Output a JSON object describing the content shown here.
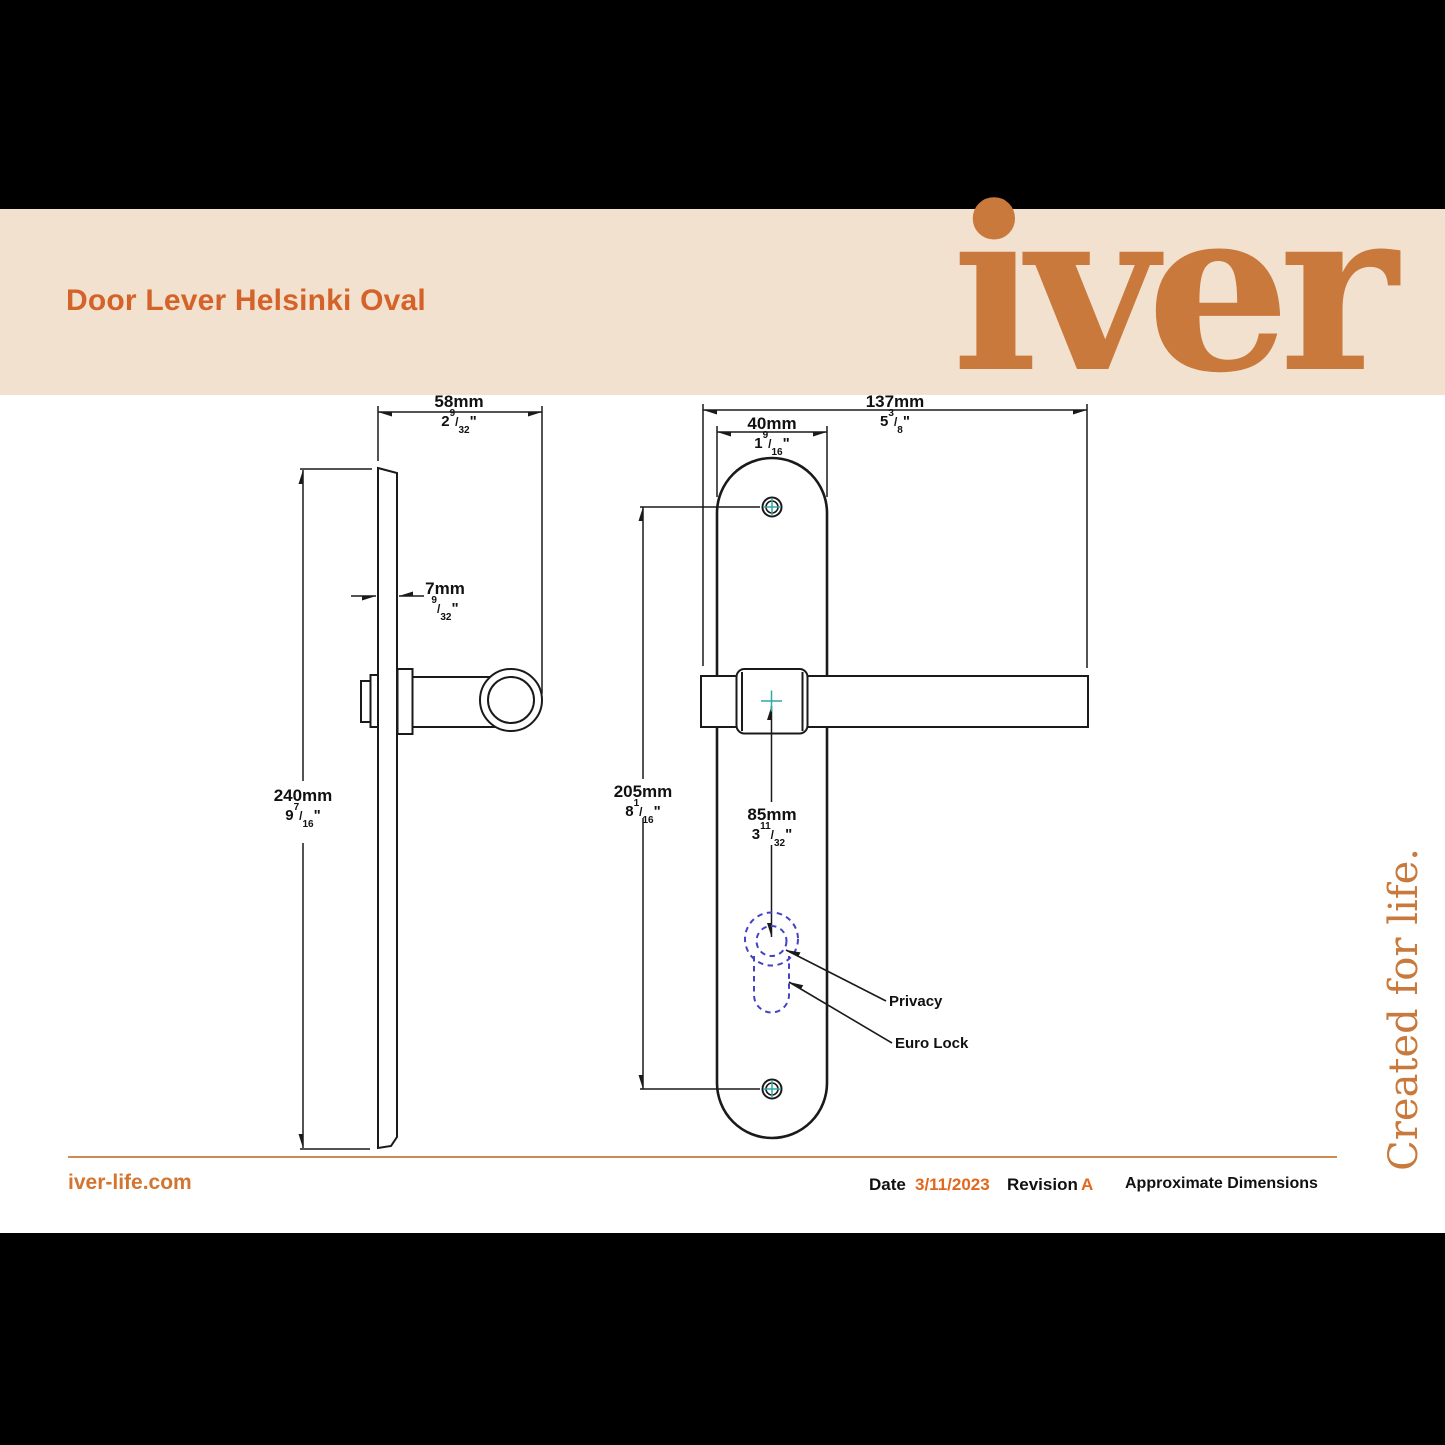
{
  "header": {
    "title": "Door Lever Helsinki Oval",
    "brand_logo": "iver"
  },
  "tagline": "Created for life.",
  "drawing": {
    "dimensions": {
      "side_width": {
        "metric": "58mm",
        "inch_whole": "2",
        "inch_num": "9",
        "inch_den": "32"
      },
      "plate_thickness": {
        "metric": "7mm",
        "inch_whole": "",
        "inch_num": "9",
        "inch_den": "32"
      },
      "plate_height": {
        "metric": "240mm",
        "inch_whole": "9",
        "inch_num": "7",
        "inch_den": "16"
      },
      "overall_width": {
        "metric": "137mm",
        "inch_whole": "5",
        "inch_num": "3",
        "inch_den": "8"
      },
      "plate_width": {
        "metric": "40mm",
        "inch_whole": "1",
        "inch_num": "9",
        "inch_den": "16"
      },
      "screw_centres": {
        "metric": "205mm",
        "inch_whole": "8",
        "inch_num": "1",
        "inch_den": "16"
      },
      "lever_to_keyhole": {
        "metric": "85mm",
        "inch_whole": "3",
        "inch_num": "11",
        "inch_den": "32"
      }
    },
    "callouts": {
      "privacy": "Privacy",
      "euro_lock": "Euro Lock"
    },
    "marks": {
      "fraction_slash": "/",
      "inch_mark": "\""
    }
  },
  "footer": {
    "website": "iver-life.com",
    "date_label": "Date",
    "date_value": "3/11/2023",
    "revision_label": "Revision",
    "revision_value": "A",
    "note": "Approximate Dimensions"
  },
  "colors": {
    "accent_orange": "#D4632A",
    "logo_orange": "#C9793B",
    "cream_band": "#F2E1CE",
    "line_black": "#1A1A1A",
    "keyhole_dash_blue": "#4343C6",
    "centre_cross_teal": "#2FA8A8",
    "footer_rule_orange": "#CC8B50",
    "date_orange": "#E2671D"
  }
}
